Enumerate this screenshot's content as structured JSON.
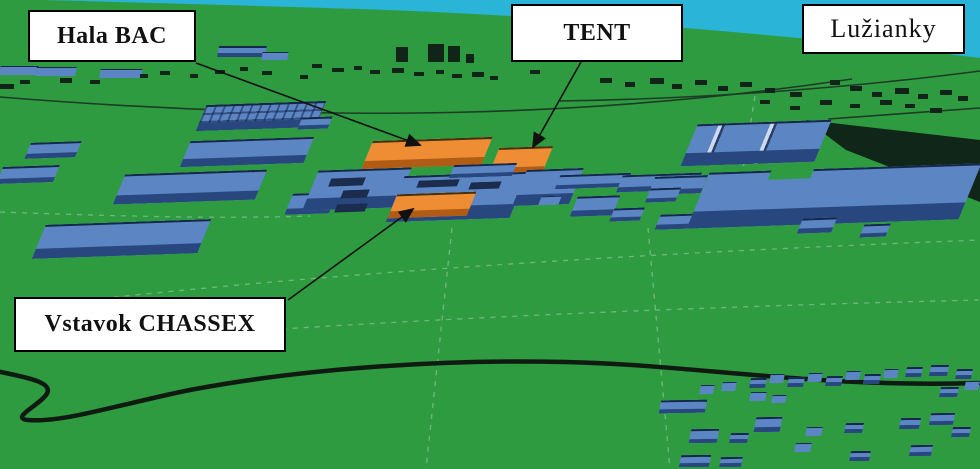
{
  "figure": {
    "labels": {
      "hala_bac": "Hala BAC",
      "tent": "TENT",
      "luzianky": "Lužianky",
      "chassex": "Vstavok CHASSEX"
    },
    "colors": {
      "sky": "#2ab4d8",
      "grass": "#2f9b41",
      "roof_blue": "#5b86c3",
      "roof_blue_front": "#27477e",
      "roof_blue_edge": "#16284a",
      "roof_orange": "#ef8d35",
      "roof_orange_front": "#b05c14",
      "roof_orange_edge": "#45300c",
      "detail_navy": "#1b2c4c",
      "dark": "#10241a",
      "label_bg": "#ffffff",
      "label_border": "#000000",
      "arrow": "#111111"
    },
    "scene": {
      "buildings": [
        [
          28,
          142,
          50,
          16,
          "b"
        ],
        [
          0,
          166,
          56,
          17,
          "b"
        ],
        [
          186,
          139,
          122,
          26,
          "b"
        ],
        [
          120,
          172,
          140,
          30,
          "b"
        ],
        [
          40,
          222,
          163,
          34,
          "b"
        ],
        [
          202,
          103,
          118,
          26,
          "b",
          "bld-grid"
        ],
        [
          300,
          117,
          30,
          12,
          "b"
        ],
        [
          289,
          193,
          44,
          21,
          "b"
        ],
        [
          368,
          139,
          118,
          28,
          "o"
        ],
        [
          494,
          147,
          53,
          28,
          "o"
        ],
        [
          311,
          169,
          92,
          40,
          "b"
        ],
        [
          396,
          174,
          122,
          46,
          "b"
        ],
        [
          452,
          164,
          62,
          13,
          "b"
        ],
        [
          520,
          169,
          56,
          36,
          "b"
        ],
        [
          558,
          174,
          70,
          14,
          "b"
        ],
        [
          620,
          174,
          78,
          17,
          "b"
        ],
        [
          574,
          196,
          42,
          20,
          "b"
        ],
        [
          612,
          208,
          30,
          13,
          "b"
        ],
        [
          658,
          214,
          44,
          15,
          "b"
        ],
        [
          700,
          205,
          36,
          13,
          "b"
        ],
        [
          540,
          196,
          20,
          9,
          "b"
        ],
        [
          330,
          178,
          34,
          8,
          "n"
        ],
        [
          342,
          190,
          26,
          8,
          "n"
        ],
        [
          336,
          204,
          30,
          8,
          "n"
        ],
        [
          418,
          180,
          40,
          7,
          "n"
        ],
        [
          470,
          182,
          30,
          7,
          "n"
        ],
        [
          430,
          196,
          34,
          7,
          "n"
        ],
        [
          690,
          122,
          132,
          42,
          "b",
          "bld-ridge"
        ],
        [
          700,
          168,
          268,
          56,
          "b"
        ],
        [
          770,
          169,
          42,
          10,
          "g"
        ],
        [
          652,
          176,
          52,
          18,
          "b"
        ],
        [
          648,
          188,
          30,
          14,
          "b"
        ],
        [
          800,
          218,
          34,
          15,
          "b"
        ],
        [
          862,
          224,
          26,
          13,
          "b"
        ],
        [
          393,
          193,
          78,
          24,
          "o"
        ],
        [
          396,
          47,
          12,
          15,
          "d",
          "",
          0,
          0
        ],
        [
          428,
          44,
          16,
          18,
          "d",
          "",
          0,
          0
        ],
        [
          448,
          46,
          12,
          16,
          "d",
          "",
          0,
          0
        ],
        [
          466,
          54,
          8,
          9,
          "d",
          "",
          0,
          0
        ],
        [
          0,
          66,
          38,
          9,
          "b",
          "",
          -10,
          0
        ],
        [
          36,
          67,
          40,
          9,
          "b",
          "",
          -10,
          0
        ],
        [
          100,
          69,
          42,
          9,
          "b",
          "",
          -10,
          0
        ],
        [
          218,
          46,
          48,
          11,
          "b",
          "",
          -10,
          0
        ],
        [
          262,
          52,
          26,
          8,
          "b",
          "",
          -10,
          0
        ]
      ],
      "houses": [
        [
          750,
          378,
          16,
          10
        ],
        [
          770,
          374,
          14,
          9
        ],
        [
          788,
          377,
          16,
          10
        ],
        [
          808,
          373,
          14,
          9
        ],
        [
          826,
          376,
          16,
          10
        ],
        [
          846,
          371,
          14,
          9
        ],
        [
          864,
          374,
          16,
          10
        ],
        [
          884,
          369,
          14,
          9
        ],
        [
          906,
          367,
          16,
          10
        ],
        [
          930,
          365,
          18,
          11
        ],
        [
          956,
          369,
          16,
          10
        ],
        [
          700,
          385,
          14,
          9
        ],
        [
          722,
          382,
          14,
          9
        ],
        [
          750,
          392,
          16,
          9
        ],
        [
          772,
          395,
          14,
          8
        ],
        [
          660,
          400,
          46,
          13
        ],
        [
          755,
          417,
          26,
          15
        ],
        [
          806,
          427,
          16,
          9
        ],
        [
          845,
          423,
          18,
          10
        ],
        [
          900,
          418,
          20,
          11
        ],
        [
          930,
          413,
          24,
          12
        ],
        [
          952,
          427,
          18,
          10
        ],
        [
          690,
          429,
          28,
          14
        ],
        [
          730,
          433,
          18,
          10
        ],
        [
          795,
          443,
          16,
          9
        ],
        [
          680,
          455,
          30,
          12
        ],
        [
          720,
          457,
          22,
          10
        ],
        [
          850,
          451,
          20,
          10
        ],
        [
          910,
          445,
          22,
          11
        ],
        [
          940,
          387,
          18,
          10
        ],
        [
          965,
          381,
          14,
          9
        ]
      ],
      "specks": [
        [
          140,
          74,
          8,
          4
        ],
        [
          160,
          71,
          10,
          4
        ],
        [
          190,
          74,
          8,
          4
        ],
        [
          215,
          70,
          10,
          4
        ],
        [
          240,
          67,
          8,
          4
        ],
        [
          262,
          71,
          10,
          4
        ],
        [
          300,
          75,
          8,
          4
        ],
        [
          312,
          64,
          10,
          4
        ],
        [
          332,
          68,
          12,
          4
        ],
        [
          354,
          66,
          8,
          4
        ],
        [
          370,
          70,
          10,
          4
        ],
        [
          392,
          68,
          12,
          5
        ],
        [
          414,
          72,
          10,
          4
        ],
        [
          436,
          70,
          8,
          4
        ],
        [
          452,
          74,
          10,
          4
        ],
        [
          472,
          72,
          12,
          5
        ],
        [
          490,
          76,
          8,
          4
        ],
        [
          530,
          70,
          10,
          4
        ],
        [
          600,
          78,
          12,
          5
        ],
        [
          625,
          82,
          10,
          5
        ],
        [
          650,
          78,
          14,
          6
        ],
        [
          672,
          84,
          10,
          5
        ],
        [
          695,
          80,
          12,
          5
        ],
        [
          718,
          86,
          10,
          5
        ],
        [
          740,
          82,
          12,
          5
        ],
        [
          765,
          88,
          10,
          5
        ],
        [
          790,
          92,
          12,
          5
        ],
        [
          820,
          100,
          12,
          5
        ],
        [
          830,
          80,
          10,
          5
        ],
        [
          850,
          86,
          12,
          5
        ],
        [
          850,
          104,
          10,
          4
        ],
        [
          872,
          92,
          10,
          5
        ],
        [
          880,
          100,
          12,
          5
        ],
        [
          895,
          88,
          14,
          6
        ],
        [
          905,
          104,
          10,
          4
        ],
        [
          918,
          94,
          10,
          5
        ],
        [
          930,
          108,
          12,
          5
        ],
        [
          940,
          90,
          12,
          5
        ],
        [
          958,
          96,
          10,
          5
        ],
        [
          760,
          100,
          10,
          4
        ],
        [
          790,
          106,
          10,
          4
        ],
        [
          0,
          84,
          14,
          5
        ],
        [
          20,
          80,
          10,
          4
        ],
        [
          60,
          78,
          12,
          5
        ],
        [
          90,
          80,
          10,
          4
        ]
      ]
    }
  }
}
